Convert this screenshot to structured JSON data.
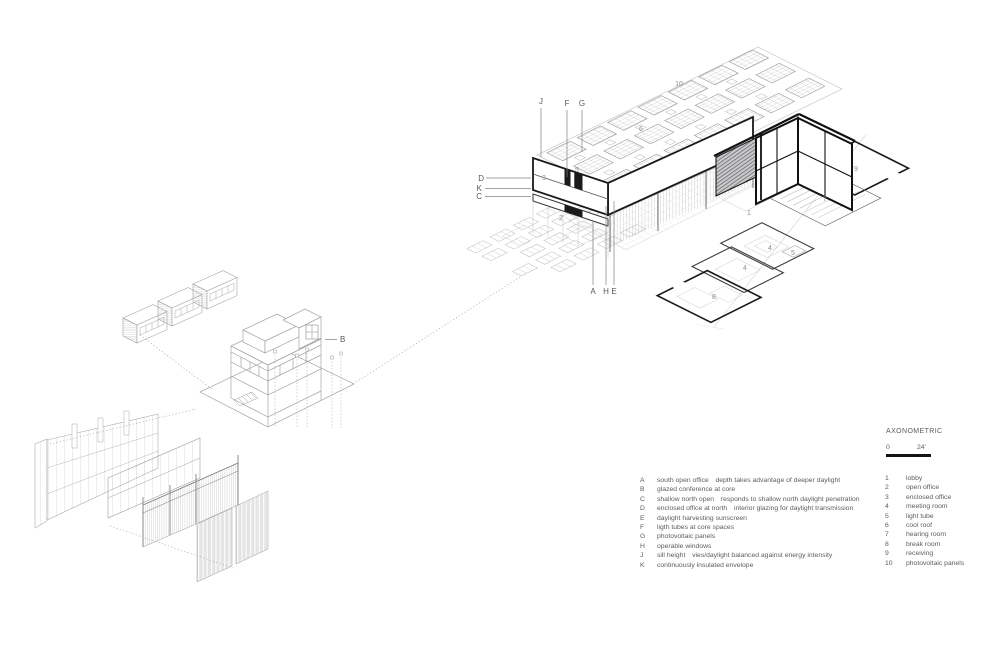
{
  "palette": {
    "ink": "#1a1a1a",
    "medium_gray": "#6d6e71",
    "light_gray": "#b5b7b9",
    "text_gray": "#58595b"
  },
  "scale_bar": {
    "title": "AXONOMETRIC",
    "start_label": "0",
    "end_label": "24'"
  },
  "drawing": {
    "callouts": [
      {
        "label": "J"
      },
      {
        "label": "F"
      },
      {
        "label": "G"
      },
      {
        "label": "D"
      },
      {
        "label": "K"
      },
      {
        "label": "C"
      },
      {
        "label": "A"
      },
      {
        "label": "H"
      },
      {
        "label": "E"
      },
      {
        "label": "B"
      }
    ],
    "numbers": [
      {
        "label": "10"
      },
      {
        "label": "6"
      },
      {
        "label": "5"
      },
      {
        "label": "3"
      },
      {
        "label": "2"
      },
      {
        "label": "1"
      },
      {
        "label": "9"
      },
      {
        "label": "7"
      },
      {
        "label": "4"
      },
      {
        "label": "5"
      },
      {
        "label": "4"
      },
      {
        "label": "8"
      }
    ]
  },
  "legend_letters": {
    "items": [
      {
        "key": "A",
        "desc": "south open office depth takes advantage of deeper daylight"
      },
      {
        "key": "B",
        "desc": "glazed conference at core"
      },
      {
        "key": "C",
        "desc": "shallow north open responds to shallow north daylight penetration"
      },
      {
        "key": "D",
        "desc": "enclosed office at north interior glazing for daylight transmission"
      },
      {
        "key": "E",
        "desc": "daylight harvesting sunscreen"
      },
      {
        "key": "F",
        "desc": "ligth tubes at core spaces"
      },
      {
        "key": "G",
        "desc": "photovoltaic panels"
      },
      {
        "key": "H",
        "desc": "operable windows"
      },
      {
        "key": "J",
        "desc": "sill height vies/daylight balanced against energy intensity"
      },
      {
        "key": "K",
        "desc": "continuously insulated envelope"
      }
    ]
  },
  "legend_numbers": {
    "items": [
      {
        "key": "1",
        "desc": "lobby"
      },
      {
        "key": "2",
        "desc": "open office"
      },
      {
        "key": "3",
        "desc": "enclosed office"
      },
      {
        "key": "4",
        "desc": "meeting room"
      },
      {
        "key": "5",
        "desc": "light tube"
      },
      {
        "key": "6",
        "desc": "cool roof"
      },
      {
        "key": "7",
        "desc": "hearing room"
      },
      {
        "key": "8",
        "desc": "break room"
      },
      {
        "key": "9",
        "desc": "receiving"
      },
      {
        "key": "10",
        "desc": "photovoltaic panels"
      }
    ]
  }
}
